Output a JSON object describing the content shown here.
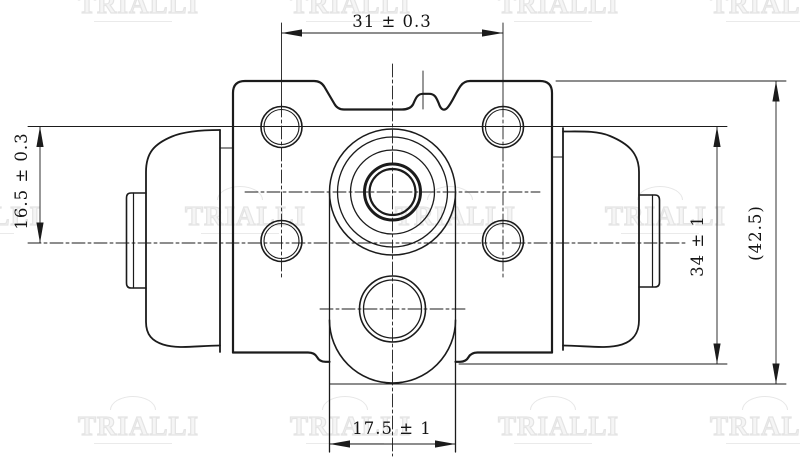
{
  "drawing": {
    "dimensions": {
      "top_width": "31 ± 0.3",
      "left_offset": "16.5 ± 0.3",
      "right_height": "34 ± 1",
      "overall_height": "(42.5)",
      "bottom_width": "17.5 ± 1"
    },
    "watermark": {
      "text": "TRIALLI"
    },
    "colors": {
      "line": "#1b1b1b",
      "thin_line": "#2a2a2a",
      "watermark": "#e7e7e7",
      "background": "#ffffff"
    }
  }
}
